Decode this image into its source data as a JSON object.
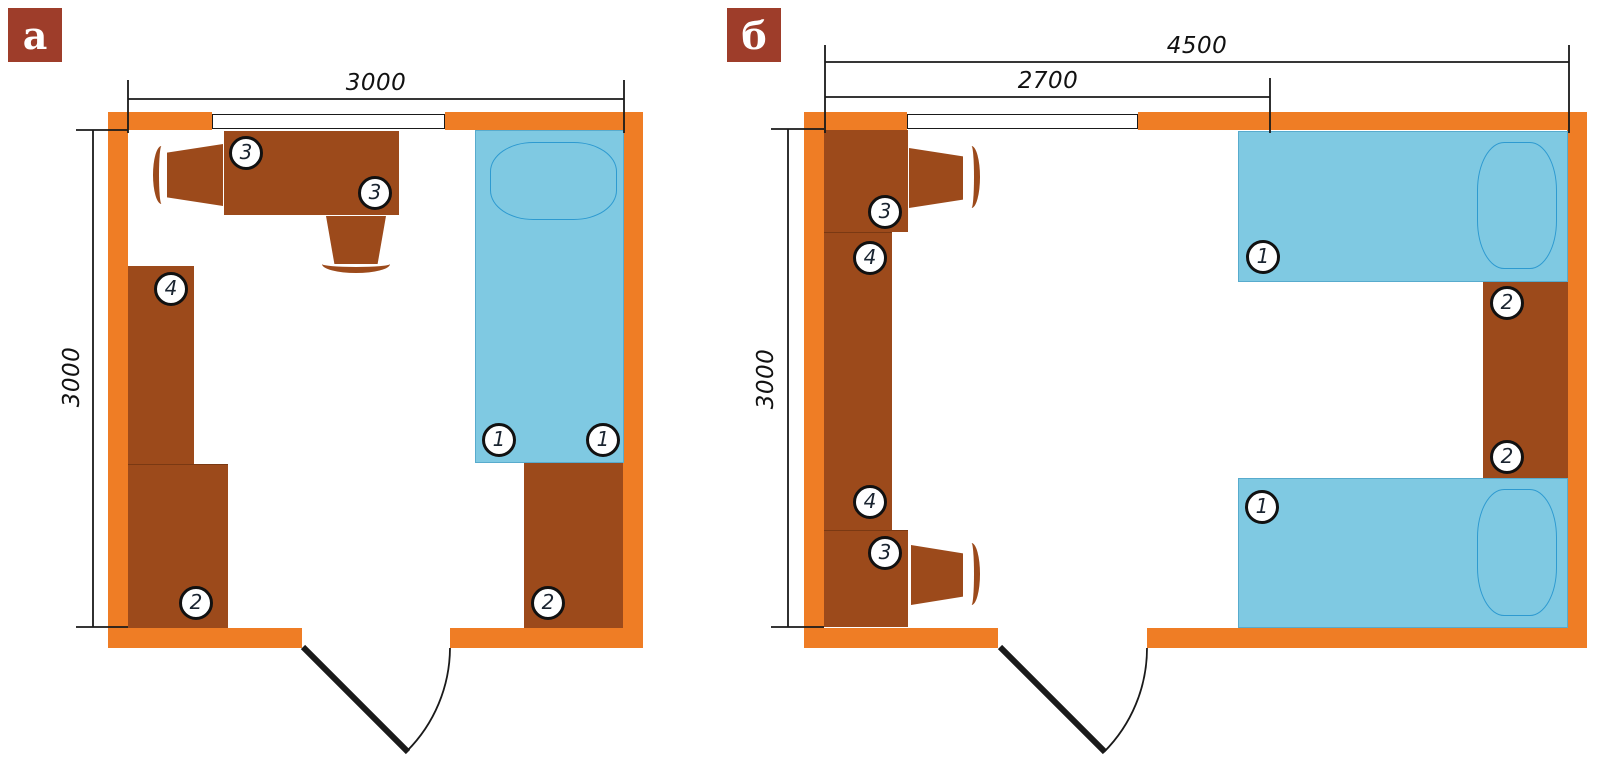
{
  "colors": {
    "wall": "#EF7D25",
    "furniture": "#9C4A1B",
    "bed": "#7FC9E2",
    "bed_outline": "#2E9AD0",
    "label_bg": "#9E3D2A",
    "line": "#1A1A1A"
  },
  "plans": {
    "a": {
      "label": "а",
      "dim_width": "3000",
      "dim_height": "3000",
      "markers": {
        "desk_left": "3",
        "desk_right": "3",
        "wardrobe": "4",
        "cabinet_left": "2",
        "bed_head": "1",
        "bed_foot": "1",
        "cabinet_right": "2"
      }
    },
    "b": {
      "label": "б",
      "dim_total_width": "4500",
      "dim_window_width": "2700",
      "dim_height": "3000",
      "markers": {
        "desk_top": "3",
        "shelf_top": "4",
        "shelf_bottom": "4",
        "desk_bottom": "3",
        "bed_top": "1",
        "cabinet_top": "2",
        "cabinet_bottom": "2",
        "bed_bottom": "1"
      }
    }
  }
}
